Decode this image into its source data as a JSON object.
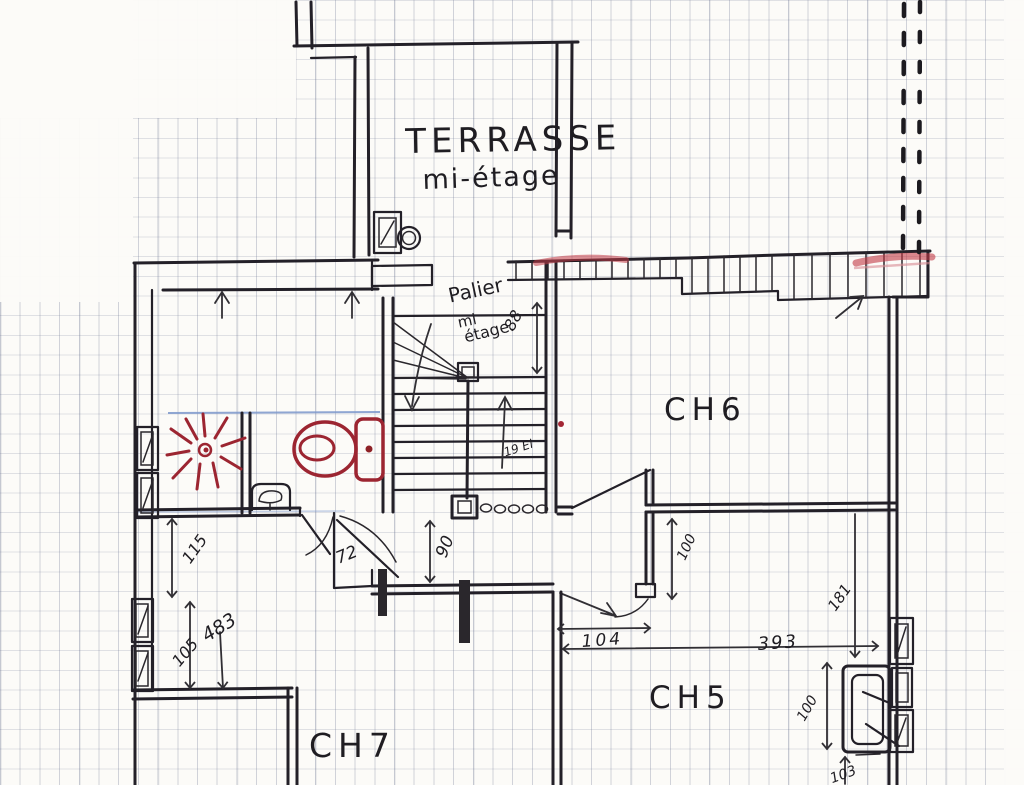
{
  "rooms": {
    "terrasse": {
      "name": "TERRASSE",
      "level": "mi-étage"
    },
    "palier": {
      "name": "Palier",
      "level_line1": "mi",
      "level_line2": "étage."
    },
    "ch6": {
      "name": "CH6"
    },
    "ch5": {
      "name": "CH5"
    },
    "ch7": {
      "name": "CH7"
    }
  },
  "stairs": {
    "annotation": "19 El",
    "direction": "up"
  },
  "dimensions": {
    "palier_width": "88",
    "door_left": "72",
    "corridor": "90",
    "door_ch5": "104",
    "left_upper": "115",
    "left_total": "483",
    "left_lower": "105",
    "ch5_door_side": "100",
    "ch5_right": "181",
    "ch5_width": "393",
    "radiator_height": "100",
    "radiator_offset": "103"
  },
  "colors": {
    "ink": "#232028",
    "fixture_red": "#9c2531",
    "highlight_red": "#c23a46",
    "pencil_blue": "#7d98cc",
    "paper": "#fcfbf8",
    "grid": "#6c7491"
  }
}
